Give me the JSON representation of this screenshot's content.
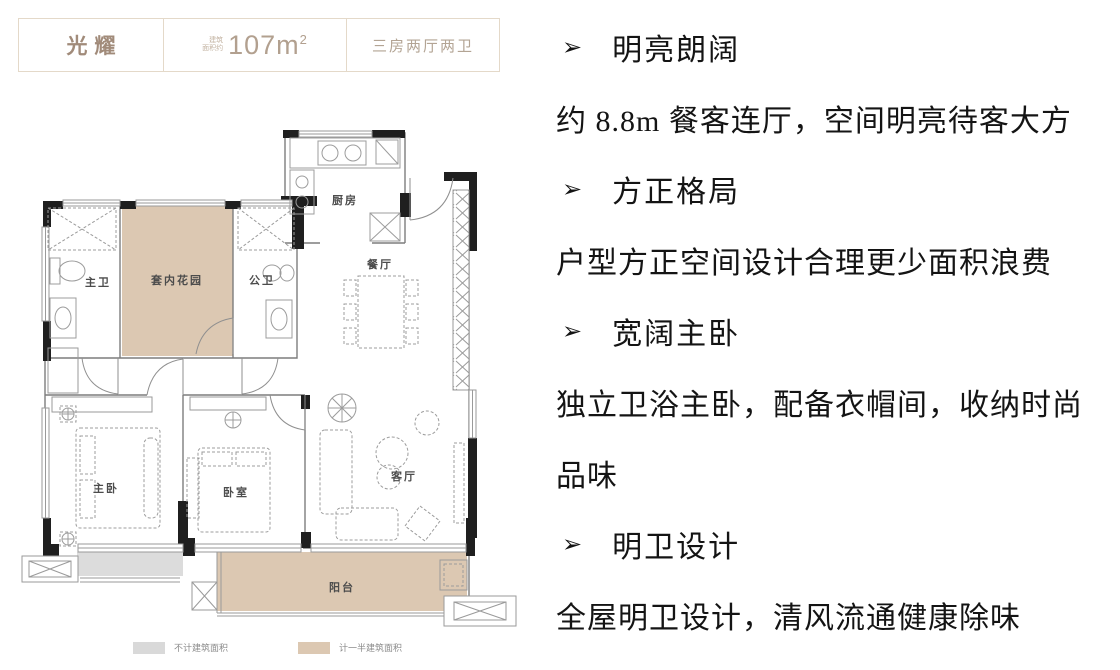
{
  "header": {
    "name": "光耀",
    "area_prefix_top": "建筑",
    "area_prefix_bottom": "面积约",
    "area_value": "107m",
    "area_exponent": "2",
    "layout_type": "三房两厅两卫"
  },
  "floorplan": {
    "rooms": {
      "master_bath": "主卫",
      "indoor_garden": "套内花园",
      "guest_bath": "公卫",
      "kitchen": "厨房",
      "dining": "餐厅",
      "master_bedroom": "主卧",
      "bedroom": "卧室",
      "living_room": "客厅",
      "balcony": "阳台"
    },
    "legend": [
      {
        "label": "不计建筑面积",
        "color": "#d9d9d9"
      },
      {
        "label": "计一半建筑面积",
        "color": "#dcc8b2"
      }
    ]
  },
  "features": [
    {
      "bullet": "➢",
      "text": "明亮朗阔"
    },
    {
      "text": "约 8.8m 餐客连厅，空间明亮待客大方"
    },
    {
      "bullet": "➢",
      "text": "方正格局"
    },
    {
      "text": "户型方正空间设计合理更少面积浪费"
    },
    {
      "bullet": "➢",
      "text": "宽阔主卧"
    },
    {
      "text": "独立卫浴主卧，配备衣帽间，收纳时尚"
    },
    {
      "text": "品味"
    },
    {
      "bullet": "➢",
      "text": "明卫设计"
    },
    {
      "text": "全屋明卫设计，清风流通健康除味"
    }
  ],
  "colors": {
    "accent_tan": "#dcc8b2",
    "accent_gray": "#dcdcdc",
    "wall": "#1f1f1f",
    "header_border": "#e4d9c9",
    "header_text": "#a18b7a"
  }
}
